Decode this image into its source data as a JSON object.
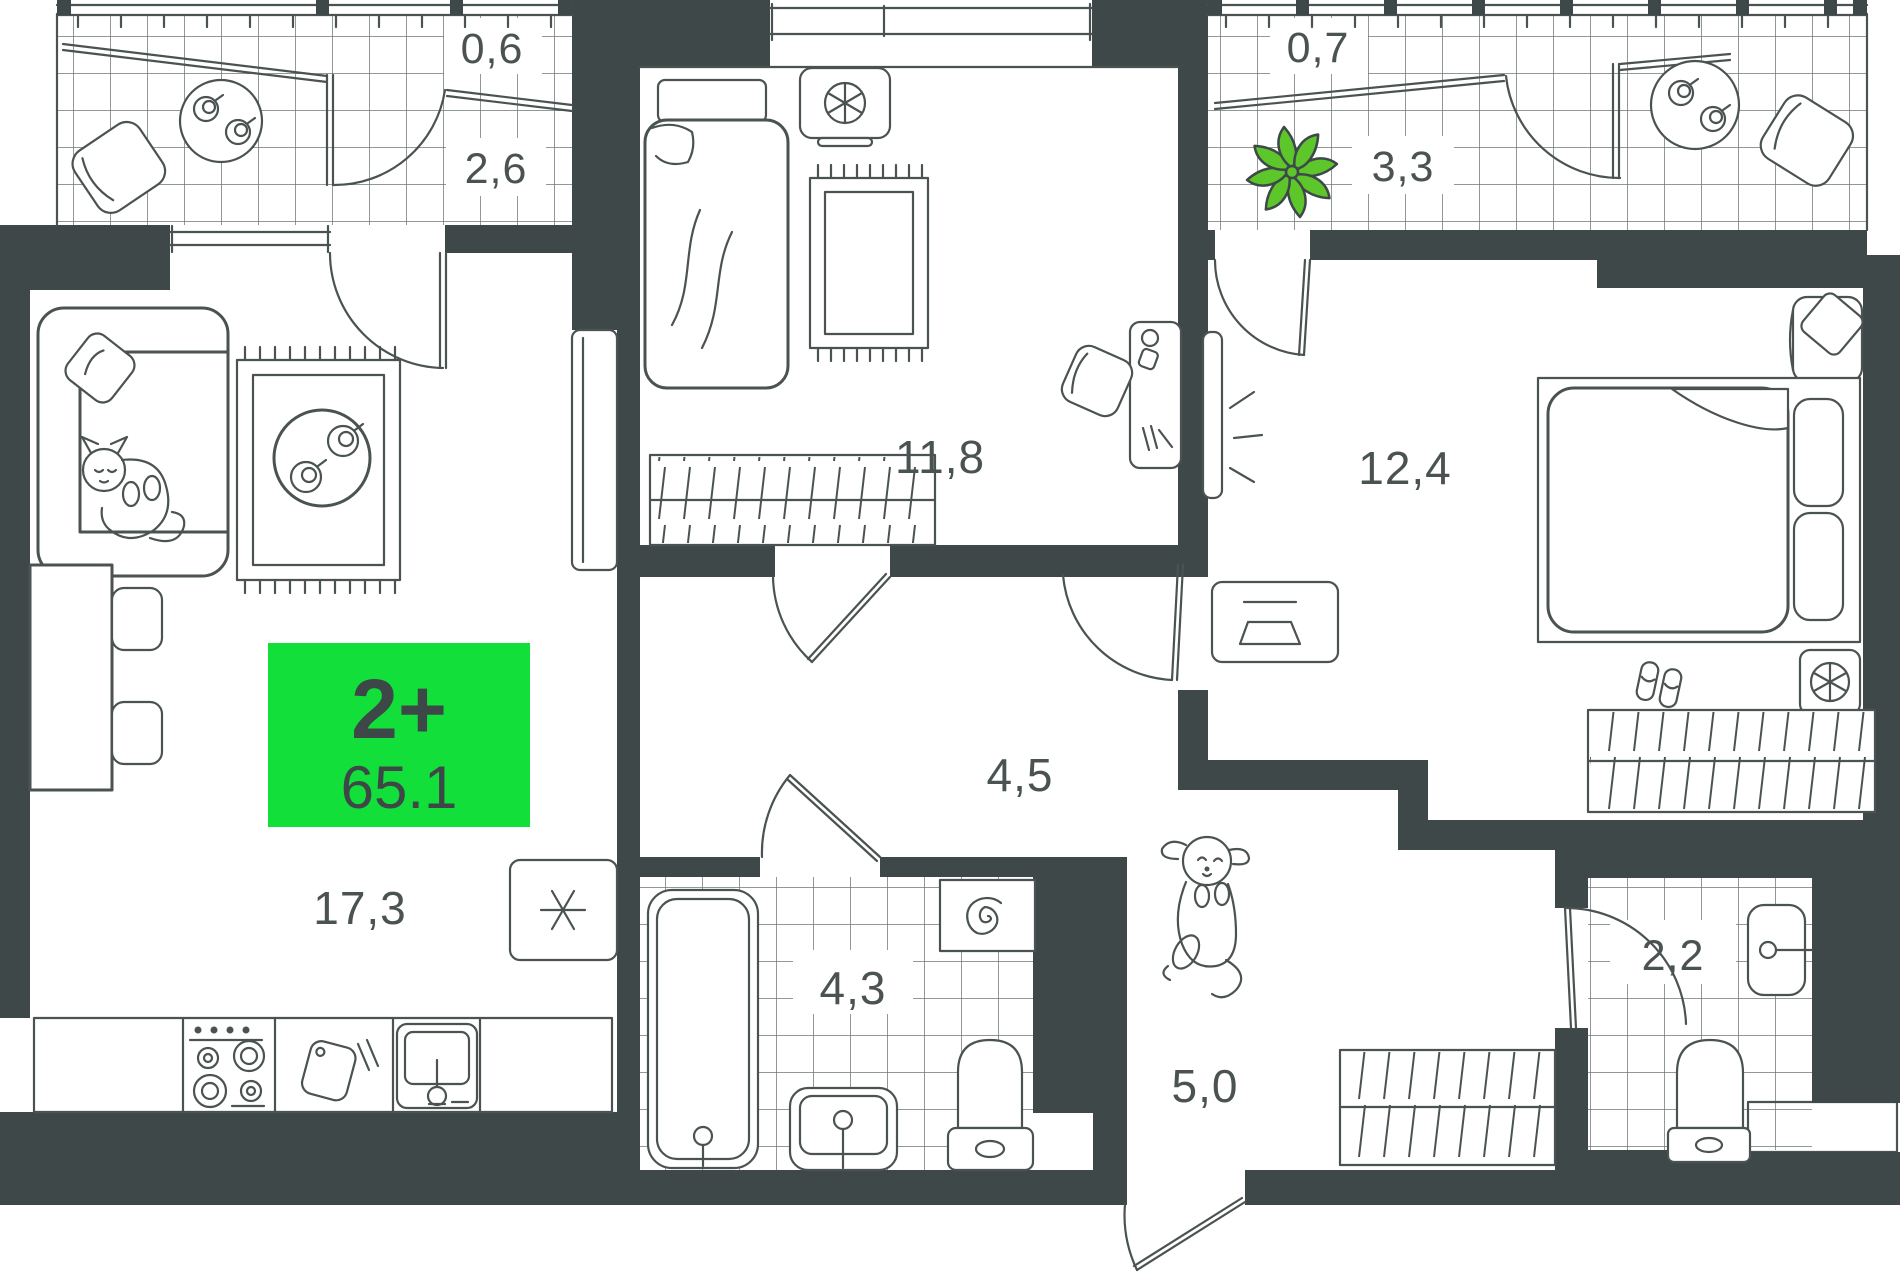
{
  "title": "Apartment floor plan",
  "badge": {
    "type_label": "2+",
    "area_value": "65.1"
  },
  "colors": {
    "wall": "#3F4849",
    "line": "#4A5352",
    "badge_green": "#12DF3A",
    "plant_green": "#5CC62B",
    "background": "#FFFFFF"
  },
  "rooms": [
    {
      "id": "balcony-left-upper",
      "area_label": "0,6"
    },
    {
      "id": "balcony-left",
      "area_label": "2,6"
    },
    {
      "id": "balcony-right-upper",
      "area_label": "0,7"
    },
    {
      "id": "balcony-right",
      "area_label": "3,3"
    },
    {
      "id": "bedroom-middle",
      "area_label": "11,8"
    },
    {
      "id": "bedroom-right",
      "area_label": "12,4"
    },
    {
      "id": "living-kitchen",
      "area_label": "17,3"
    },
    {
      "id": "hallway",
      "area_label": "4,5"
    },
    {
      "id": "bathroom",
      "area_label": "4,3"
    },
    {
      "id": "corridor",
      "area_label": "5,0"
    },
    {
      "id": "wc",
      "area_label": "2,2"
    }
  ]
}
